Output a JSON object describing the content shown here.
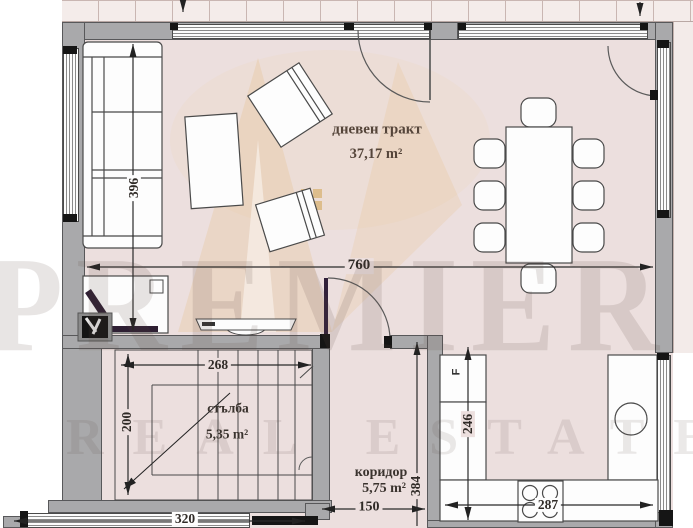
{
  "watermark": {
    "brand": "PREMIER",
    "tagline": "REAL ESTATE"
  },
  "rooms": {
    "living": {
      "name": "дневен тракт",
      "area": "37,17 m²"
    },
    "stairs": {
      "name": "стълба",
      "area": "5,35 m²"
    },
    "corridor": {
      "name": "коридор",
      "area": "5,75 m²"
    }
  },
  "appliances": {
    "fridge_label": "F"
  },
  "dimensions": {
    "living_depth": "396",
    "living_width": "760",
    "stairs_width": "268",
    "stairs_depth": "200",
    "bottom_window": "320",
    "corridor_width": "150",
    "corridor_length": "384",
    "kitchen_depth": "246",
    "kitchen_width": "287"
  },
  "colors": {
    "floor": "#ecdfde",
    "wall": "#a9a9ab",
    "label_text": "#55453a",
    "door_leaf": "#31203a",
    "watermark_gold": "#e4b269"
  }
}
